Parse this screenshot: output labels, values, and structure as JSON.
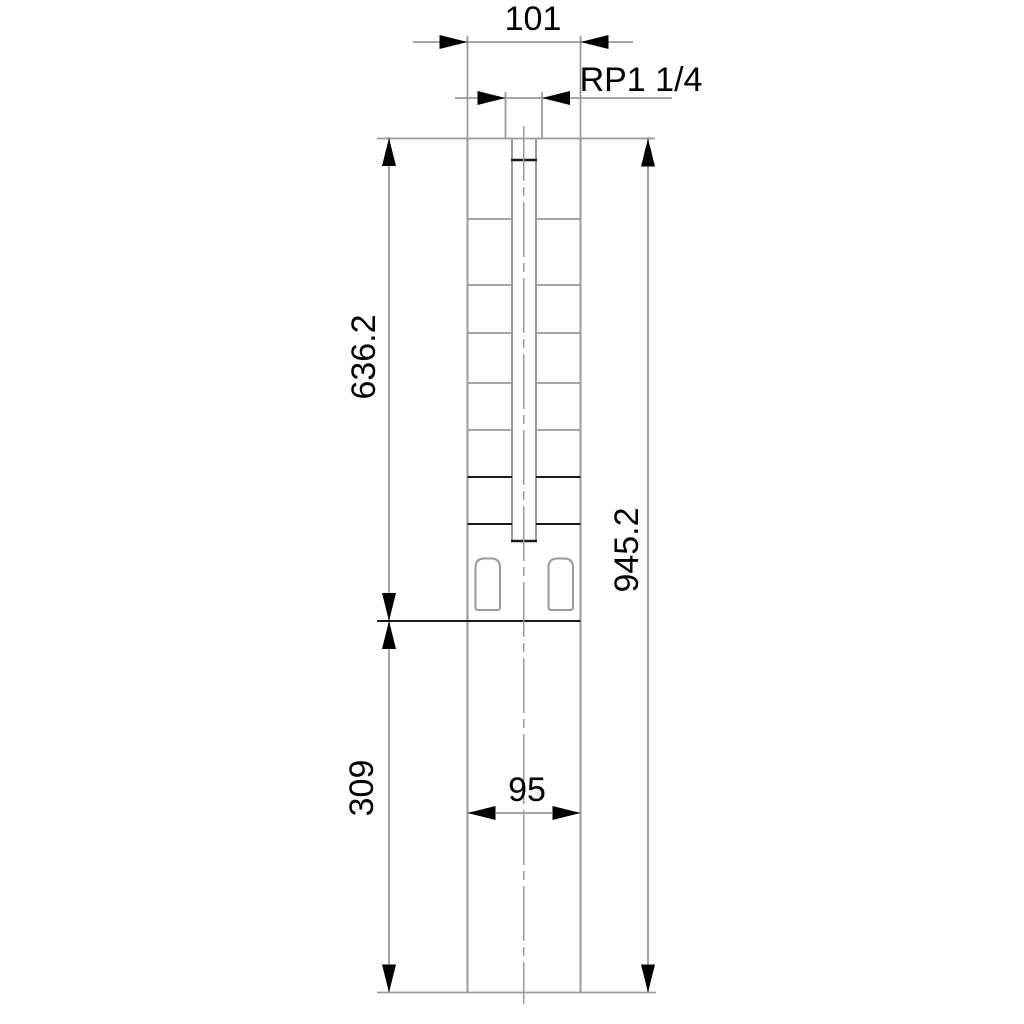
{
  "drawing": {
    "kind": "dimensioned-outline-drawing",
    "dimensions": {
      "outlet_width": "101",
      "outlet_thread": "RP1 1/4",
      "pump_section_length": "636.2",
      "total_length": "945.2",
      "motor_section_length": "309",
      "motor_width": "95"
    },
    "colors": {
      "line_gray": "#9a9a9a",
      "line_black": "#1a1a1a",
      "text": "#000000",
      "background": "#ffffff"
    }
  }
}
